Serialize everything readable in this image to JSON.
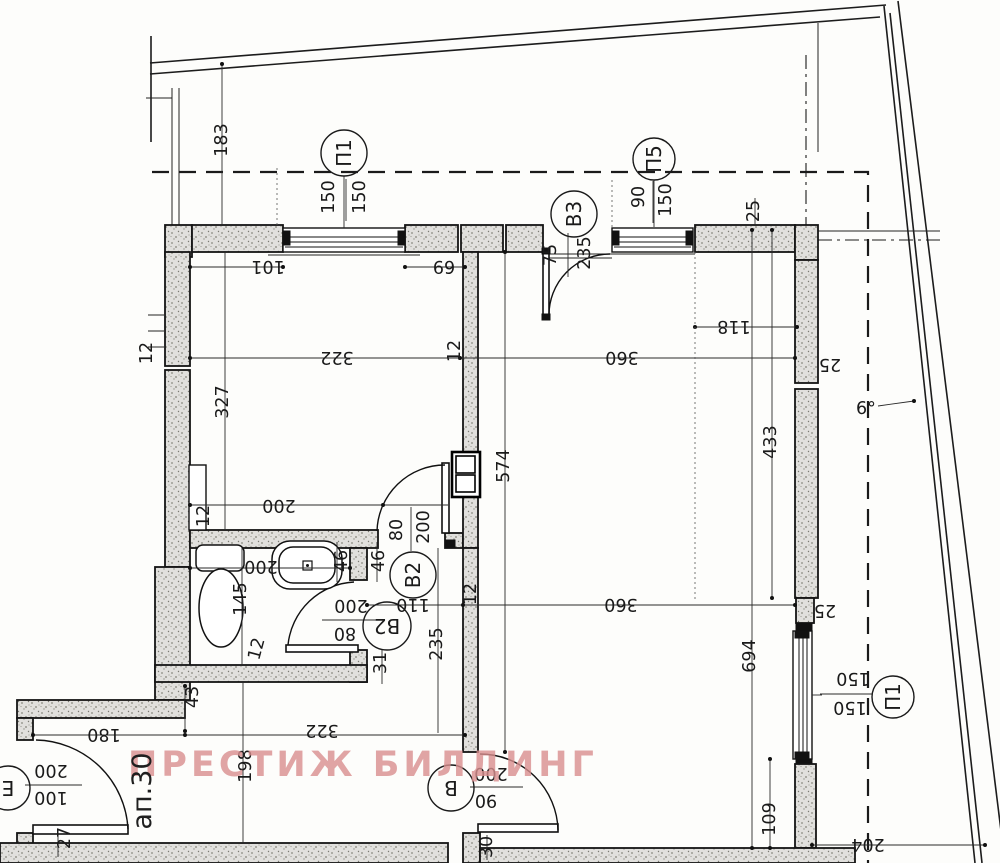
{
  "watermark": {
    "text": "ПРЕСТИЖ БИЛДИНГ",
    "color": "#d98f8f"
  },
  "apartment_label": "ап.30",
  "opening_tags": [
    {
      "tag": "П1",
      "cx": 344,
      "cy": 153,
      "r": 23,
      "rot": -90
    },
    {
      "tag": "В3",
      "cx": 574,
      "cy": 214,
      "r": 23,
      "rot": -90
    },
    {
      "tag": "П5",
      "cx": 654,
      "cy": 159,
      "r": 21,
      "rot": -90
    },
    {
      "tag": "В2",
      "cx": 413,
      "cy": 575,
      "r": 23,
      "rot": -90
    },
    {
      "tag": "В2",
      "cx": 387,
      "cy": 626,
      "r": 24,
      "rot": 180
    },
    {
      "tag": "В",
      "cx": 451,
      "cy": 788,
      "r": 23,
      "rot": 180
    },
    {
      "tag": "П1",
      "cx": 893,
      "cy": 697,
      "r": 21,
      "rot": -90
    },
    {
      "tag": "Е",
      "cx": 8,
      "cy": 788,
      "r": 22,
      "rot": 180
    }
  ],
  "dimensions": [
    {
      "t": "183",
      "x": 222,
      "y": 140,
      "r": -90
    },
    {
      "t": "150",
      "x": 329,
      "y": 197,
      "r": -90
    },
    {
      "t": "150",
      "x": 360,
      "y": 197,
      "r": -90
    },
    {
      "t": "101",
      "x": 268,
      "y": 266,
      "r": 180
    },
    {
      "t": "69",
      "x": 444,
      "y": 266,
      "r": 180
    },
    {
      "t": "75",
      "x": 551,
      "y": 255,
      "r": -90
    },
    {
      "t": "235",
      "x": 585,
      "y": 253,
      "r": -90
    },
    {
      "t": "90",
      "x": 639,
      "y": 197,
      "r": -90
    },
    {
      "t": "150",
      "x": 666,
      "y": 200,
      "r": -90
    },
    {
      "t": "25",
      "x": 754,
      "y": 211,
      "r": -90
    },
    {
      "t": "118",
      "x": 734,
      "y": 326,
      "r": 180
    },
    {
      "t": "322",
      "x": 337,
      "y": 357,
      "r": 180
    },
    {
      "t": "12",
      "x": 455,
      "y": 351,
      "r": -90
    },
    {
      "t": "360",
      "x": 622,
      "y": 357,
      "r": 180
    },
    {
      "t": "327",
      "x": 223,
      "y": 402,
      "r": -90
    },
    {
      "t": "12",
      "x": 147,
      "y": 353,
      "r": -90
    },
    {
      "t": "574",
      "x": 504,
      "y": 466,
      "r": -90
    },
    {
      "t": "433",
      "x": 771,
      "y": 442,
      "r": -90
    },
    {
      "t": "694",
      "x": 750,
      "y": 656,
      "r": -90
    },
    {
      "t": "25",
      "x": 830,
      "y": 364,
      "r": 180
    },
    {
      "t": "6°",
      "x": 866,
      "y": 409,
      "r": 0
    },
    {
      "t": "200",
      "x": 279,
      "y": 505,
      "r": 180
    },
    {
      "t": "12",
      "x": 204,
      "y": 516,
      "r": -90
    },
    {
      "t": "80",
      "x": 397,
      "y": 530,
      "r": -90
    },
    {
      "t": "200",
      "x": 424,
      "y": 527,
      "r": -90
    },
    {
      "t": "46",
      "x": 342,
      "y": 561,
      "r": -90
    },
    {
      "t": "46",
      "x": 379,
      "y": 561,
      "r": -90
    },
    {
      "t": "200",
      "x": 261,
      "y": 566,
      "r": 180
    },
    {
      "t": "145",
      "x": 241,
      "y": 599,
      "r": -90
    },
    {
      "t": "12",
      "x": 257,
      "y": 649,
      "r": -75
    },
    {
      "t": "200",
      "x": 351,
      "y": 605,
      "r": 180
    },
    {
      "t": "80",
      "x": 345,
      "y": 633,
      "r": 180
    },
    {
      "t": "110",
      "x": 413,
      "y": 604,
      "r": 180
    },
    {
      "t": "360",
      "x": 621,
      "y": 604,
      "r": 180
    },
    {
      "t": "12",
      "x": 471,
      "y": 594,
      "r": -90
    },
    {
      "t": "235",
      "x": 437,
      "y": 644,
      "r": -90
    },
    {
      "t": "31",
      "x": 381,
      "y": 663,
      "r": -90
    },
    {
      "t": "25",
      "x": 825,
      "y": 610,
      "r": 180
    },
    {
      "t": "150",
      "x": 853,
      "y": 678,
      "r": 180
    },
    {
      "t": "150",
      "x": 850,
      "y": 707,
      "r": 180
    },
    {
      "t": "109",
      "x": 770,
      "y": 819,
      "r": -90
    },
    {
      "t": "204",
      "x": 868,
      "y": 844,
      "r": 180
    },
    {
      "t": "43",
      "x": 193,
      "y": 697,
      "r": -90
    },
    {
      "t": "180",
      "x": 104,
      "y": 734,
      "r": 180
    },
    {
      "t": "322",
      "x": 322,
      "y": 730,
      "r": 180
    },
    {
      "t": "198",
      "x": 246,
      "y": 766,
      "r": -90
    },
    {
      "t": "27",
      "x": 65,
      "y": 838,
      "r": -90
    },
    {
      "t": "200",
      "x": 51,
      "y": 770,
      "r": 180
    },
    {
      "t": "100",
      "x": 51,
      "y": 797,
      "r": 180
    },
    {
      "t": "200",
      "x": 491,
      "y": 773,
      "r": 180
    },
    {
      "t": "90",
      "x": 486,
      "y": 800,
      "r": 180
    },
    {
      "t": "30",
      "x": 487,
      "y": 847,
      "r": -90
    }
  ]
}
